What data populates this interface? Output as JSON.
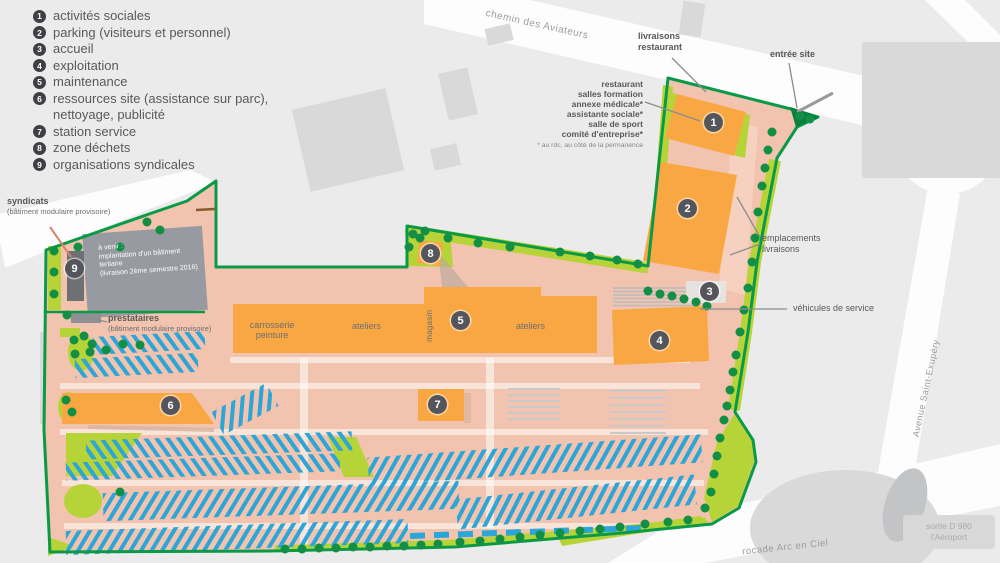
{
  "legend": {
    "items": [
      {
        "n": "1",
        "label": "activités sociales"
      },
      {
        "n": "2",
        "label": "parking (visiteurs et personnel)"
      },
      {
        "n": "3",
        "label": "accueil"
      },
      {
        "n": "4",
        "label": "exploitation"
      },
      {
        "n": "5",
        "label": "maintenance"
      },
      {
        "n": "6",
        "label": "ressources site (assistance sur parc),",
        "label2": "nettoyage, publicité"
      },
      {
        "n": "7",
        "label": "station service"
      },
      {
        "n": "8",
        "label": "zone déchets"
      },
      {
        "n": "9",
        "label": "organisations syndicales"
      }
    ]
  },
  "map": {
    "roads": {
      "chemin": "chemin des Aviateurs",
      "rocade": "rocade Arc en Ciel",
      "avenue": "Avenue Saint-Exupéry"
    },
    "exit_box": {
      "line1": "sortie D 980",
      "line2": "l'Aéroport"
    },
    "annotations": {
      "livraisons": "livraisons restaurant",
      "entree": "entrée site",
      "ne_services": [
        "restaurant",
        "salles formation",
        "annexe médicale*",
        "assistante sociale*",
        "salle de sport",
        "comité d'entreprise*"
      ],
      "ne_footnote": "* au rdc, au côté de la permanence",
      "emplacements": "emplacements livraisons",
      "vehicules": "véhicules de service",
      "syndicats": "syndicats",
      "syndicats_sub": "(bâtiment modulaire provisoire)",
      "prestataires": "prestataires",
      "prestataires_sub": "(bâtiment modulaire provisoire)",
      "avenir": [
        "à venir :",
        "implantation d'un bâtiment",
        "tertiaire",
        "(livraison 2ème semestre 2016)"
      ]
    },
    "building_labels": {
      "carrosserie": "carrosserie peinture",
      "ateliers_left": "ateliers",
      "magasin": "magasin",
      "ateliers_right": "ateliers"
    },
    "markers": [
      "1",
      "2",
      "3",
      "4",
      "5",
      "6",
      "7",
      "8",
      "9"
    ]
  },
  "colors": {
    "site_pink": "#f2c3ae",
    "building_orange": "#f9a743",
    "lawn_green": "#b6d437",
    "boundary_green": "#0a9a47",
    "tree_green": "#128f45",
    "parking_blue": "#2ca5d8",
    "marker_gray": "#54565b",
    "background": "#ebebeb",
    "neighbor_gray": "#d9d9d9",
    "legend_text": "#58595b"
  }
}
